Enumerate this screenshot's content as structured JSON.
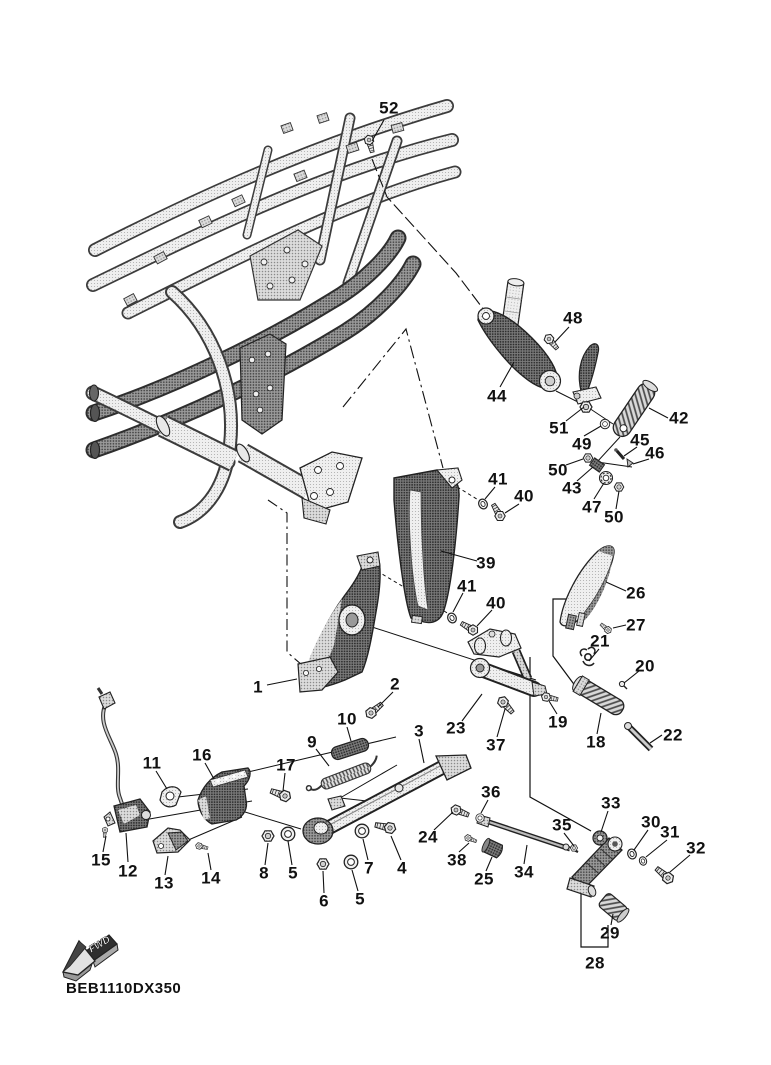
{
  "colors": {
    "ink": "#1a1a1a",
    "paper": "#ffffff"
  },
  "diagram": {
    "part_code": "BEB1110DX350",
    "fwd_label": "FWD",
    "labels": [
      {
        "n": "52",
        "x": 389,
        "y": 108
      },
      {
        "n": "48",
        "x": 573,
        "y": 318
      },
      {
        "n": "44",
        "x": 497,
        "y": 396
      },
      {
        "n": "51",
        "x": 559,
        "y": 428
      },
      {
        "n": "42",
        "x": 679,
        "y": 418
      },
      {
        "n": "49",
        "x": 582,
        "y": 444
      },
      {
        "n": "45",
        "x": 640,
        "y": 440
      },
      {
        "n": "46",
        "x": 655,
        "y": 453
      },
      {
        "n": "50",
        "x": 558,
        "y": 470
      },
      {
        "n": "43",
        "x": 572,
        "y": 488
      },
      {
        "n": "47",
        "x": 592,
        "y": 507
      },
      {
        "n": "50",
        "x": 614,
        "y": 517
      },
      {
        "n": "41",
        "x": 498,
        "y": 479
      },
      {
        "n": "40",
        "x": 524,
        "y": 496
      },
      {
        "n": "39",
        "x": 486,
        "y": 563
      },
      {
        "n": "41",
        "x": 467,
        "y": 586
      },
      {
        "n": "40",
        "x": 496,
        "y": 603
      },
      {
        "n": "26",
        "x": 636,
        "y": 593
      },
      {
        "n": "27",
        "x": 636,
        "y": 625
      },
      {
        "n": "21",
        "x": 600,
        "y": 641
      },
      {
        "n": "20",
        "x": 645,
        "y": 666
      },
      {
        "n": "1",
        "x": 258,
        "y": 687
      },
      {
        "n": "2",
        "x": 395,
        "y": 684
      },
      {
        "n": "10",
        "x": 347,
        "y": 719
      },
      {
        "n": "9",
        "x": 312,
        "y": 742
      },
      {
        "n": "3",
        "x": 419,
        "y": 731
      },
      {
        "n": "23",
        "x": 456,
        "y": 728
      },
      {
        "n": "37",
        "x": 496,
        "y": 745
      },
      {
        "n": "19",
        "x": 558,
        "y": 722
      },
      {
        "n": "18",
        "x": 596,
        "y": 742
      },
      {
        "n": "22",
        "x": 673,
        "y": 735
      },
      {
        "n": "16",
        "x": 202,
        "y": 755
      },
      {
        "n": "11",
        "x": 152,
        "y": 763
      },
      {
        "n": "17",
        "x": 286,
        "y": 765
      },
      {
        "n": "36",
        "x": 491,
        "y": 792
      },
      {
        "n": "33",
        "x": 611,
        "y": 803
      },
      {
        "n": "35",
        "x": 562,
        "y": 825
      },
      {
        "n": "30",
        "x": 651,
        "y": 822
      },
      {
        "n": "31",
        "x": 670,
        "y": 832
      },
      {
        "n": "24",
        "x": 428,
        "y": 837
      },
      {
        "n": "32",
        "x": 696,
        "y": 848
      },
      {
        "n": "15",
        "x": 101,
        "y": 860
      },
      {
        "n": "12",
        "x": 128,
        "y": 871
      },
      {
        "n": "38",
        "x": 457,
        "y": 860
      },
      {
        "n": "25",
        "x": 484,
        "y": 879
      },
      {
        "n": "34",
        "x": 524,
        "y": 872
      },
      {
        "n": "13",
        "x": 164,
        "y": 883
      },
      {
        "n": "14",
        "x": 211,
        "y": 878
      },
      {
        "n": "8",
        "x": 264,
        "y": 873
      },
      {
        "n": "5",
        "x": 293,
        "y": 873
      },
      {
        "n": "7",
        "x": 369,
        "y": 868
      },
      {
        "n": "4",
        "x": 402,
        "y": 868
      },
      {
        "n": "6",
        "x": 324,
        "y": 901
      },
      {
        "n": "5",
        "x": 360,
        "y": 899
      },
      {
        "n": "29",
        "x": 610,
        "y": 933
      },
      {
        "n": "28",
        "x": 595,
        "y": 963
      }
    ]
  }
}
